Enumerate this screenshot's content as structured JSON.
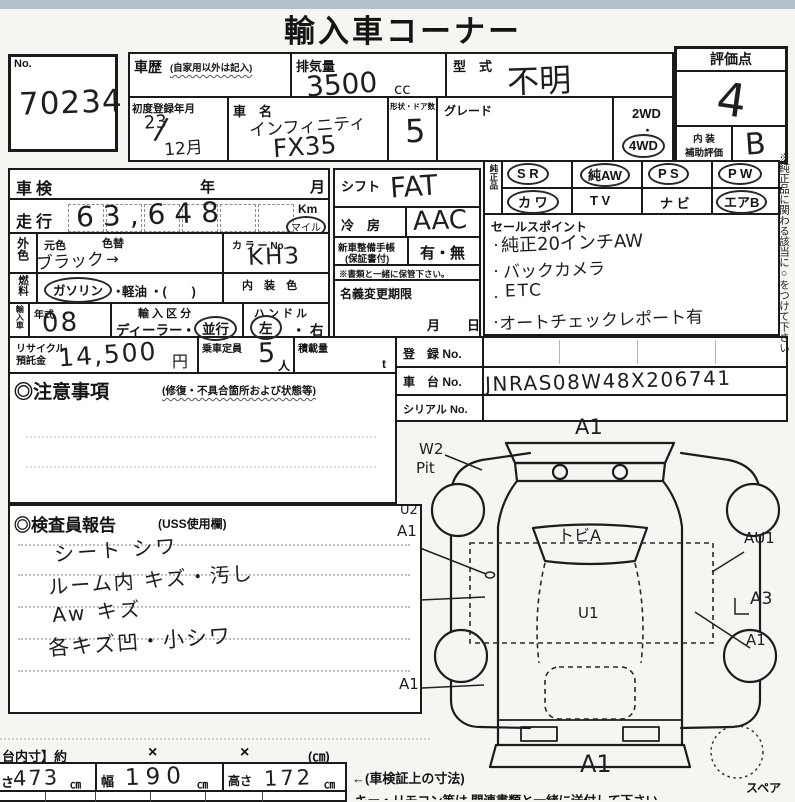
{
  "page": {
    "title": "輸入車コーナー",
    "side_note": "※純正品に関わる該当に○をつけて下さい"
  },
  "header": {
    "no_label": "No.",
    "no_value": "70234",
    "history_label": "車歴",
    "history_note": "(自家用以外は記入)",
    "displacement_label": "排気量",
    "displacement_value": "3500",
    "displacement_unit": "cc",
    "model_label": "型　式",
    "model_value": "不明",
    "first_reg_label": "初度登録年月",
    "first_reg_year": "23",
    "first_reg_slash": "/",
    "first_reg_month": "12月",
    "name_label": "車　名",
    "name_line1": "インフィニティ",
    "name_line2": "FX35",
    "doors_label": "形状・ドア数",
    "doors_value": "5",
    "grade_label": "グレード",
    "wd2": "2WD",
    "wd_dot": "・",
    "wd4": "4WD",
    "score_label": "評価点",
    "score_value": "4",
    "interior_label1": "内 装",
    "interior_label2": "補助評価",
    "interior_value": "B"
  },
  "left": {
    "shaken_label": "車検",
    "shaken_year": "年",
    "shaken_month": "月",
    "mileage_label": "走行",
    "mileage_value": "63,648",
    "km": "Km",
    "mile": "マイル",
    "color_label": "外色",
    "base_color_label": "元色",
    "color_change_label": "色替",
    "color_no_label": "カ ラ ー No.",
    "color_value": "ブラック",
    "color_arrow": "→",
    "color_no_value": "KH3",
    "fuel_label": "燃料",
    "fuel_gasoline": "ガソリン",
    "fuel_dot": "・",
    "fuel_diesel": "軽油",
    "fuel_paren": "・(　　)",
    "interior_color_label": "内 装 色",
    "import_label": "輸入車",
    "year_model_label": "年式",
    "year_model_value": "08",
    "import_class_label": "輸 入 区 分",
    "import_dealer": "ディーラー",
    "import_dot": "・",
    "import_parallel": "並行",
    "handle_label": "ハ ン ド ル",
    "handle_left": "左",
    "handle_dot": "・",
    "handle_right": "右"
  },
  "mid": {
    "shift_label": "シフト",
    "shift_value": "FAT",
    "ac_label": "冷　房",
    "ac_value": "AAC",
    "book_label": "新車整備手帳",
    "book_note": "(保証書付)",
    "book_value": "有・無",
    "keep_note": "※書類と一緒に保管下さい。",
    "transfer_label": "名義変更期限",
    "transfer_month": "月",
    "transfer_day": "日"
  },
  "equipment": {
    "label": "純正品",
    "items": [
      {
        "text": "S R"
      },
      {
        "text": "純AW"
      },
      {
        "text": "P S"
      },
      {
        "text": "P W"
      },
      {
        "text": "カ ワ"
      },
      {
        "text": "T V"
      },
      {
        "text": "ナ ビ"
      },
      {
        "text": "エアB"
      }
    ]
  },
  "sales": {
    "label": "セールスポイント",
    "bullet": "・",
    "points": [
      "純正20インチAW",
      "バックカメラ",
      "ETC",
      "オートチェックレポート有"
    ]
  },
  "recycle": {
    "label1": "リサイクル",
    "label2": "預託金",
    "value": "14,500",
    "unit": "円",
    "capacity_label": "乗車定員",
    "capacity_value": "5",
    "capacity_unit": "人",
    "load_label": "積載量",
    "load_unit": "t"
  },
  "registration": {
    "reg_label": "登　録 No.",
    "chassis_label": "車　台 No.",
    "chassis_value": "JNRAS08W48X206741",
    "serial_label": "シリアル No."
  },
  "cautions": {
    "title": "◎注意事項",
    "note": "(修復・不具合箇所および状態等)"
  },
  "inspector": {
    "title": "◎検査員報告",
    "note": "(USS使用欄)",
    "lines": [
      "シート シワ",
      "ルーム内 キズ・汚し",
      "Aw キズ",
      "各キズ凹・小シワ"
    ]
  },
  "diagram": {
    "labels": [
      "A1",
      "W2",
      "Pit",
      "U2",
      "A1",
      "トビA",
      "AU1",
      "A3",
      "U1",
      "A1",
      "A1",
      "A1"
    ],
    "spare": "スペア"
  },
  "dims": {
    "inner_label": "台内寸】約",
    "x1": "×",
    "x2": "×",
    "cm_label": "(㎝)",
    "len_label": "さ",
    "len_value": "473",
    "len_unit": "㎝",
    "wid_label": "幅",
    "wid_value": "190",
    "wid_unit": "㎝",
    "hgt_label": "高さ",
    "hgt_value": "172",
    "hgt_unit": "㎝",
    "doc_note": "←(車検証上の寸法)",
    "bottom_note": "キー・リモコン等は 関連書類と一緒に送付して下さい"
  }
}
